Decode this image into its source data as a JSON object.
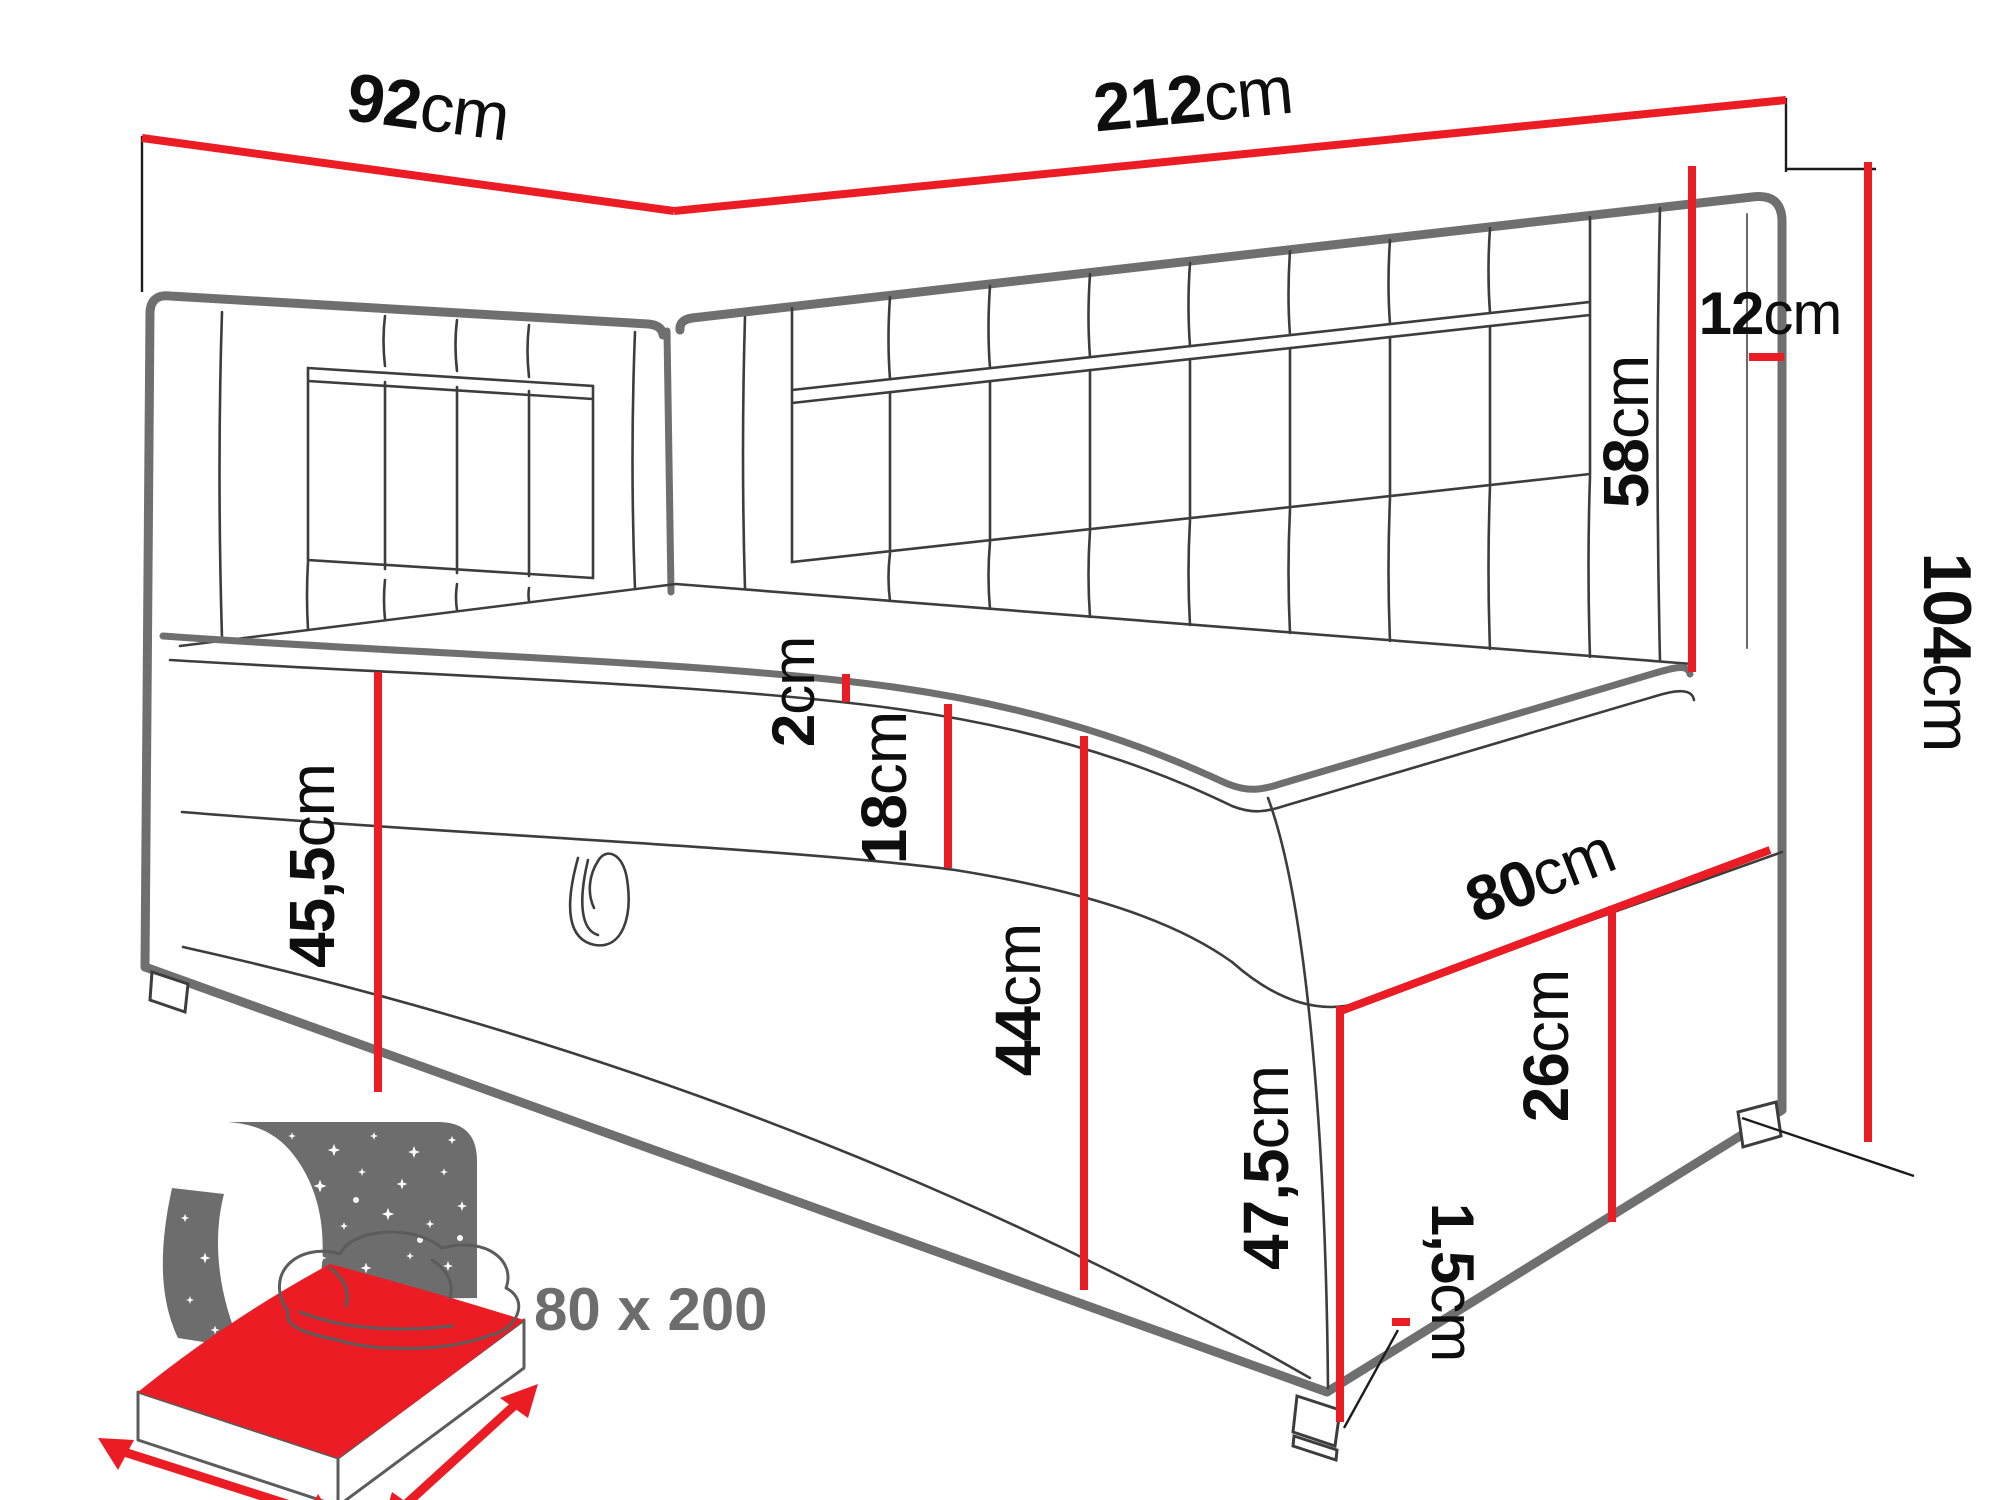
{
  "title": "corner-bed-dimension-diagram",
  "colors": {
    "dimension_red": "#ec1c24",
    "outline_gray": "#6f6f6f",
    "icon_gray": "#6d6d6d",
    "text": "#0e0e0e"
  },
  "dims": {
    "side_width": {
      "value": "92",
      "unit": "cm"
    },
    "back_width": {
      "value": "212",
      "unit": "cm"
    },
    "panel_thickness": {
      "value": "12",
      "unit": "cm"
    },
    "headboard_above_seat": {
      "value": "58",
      "unit": "cm"
    },
    "total_height": {
      "value": "104",
      "unit": "cm"
    },
    "topper_thickness": {
      "value": "2",
      "unit": "cm"
    },
    "mattress_height": {
      "value": "18",
      "unit": "cm"
    },
    "base_height": {
      "value": "44",
      "unit": "cm"
    },
    "seat_height": {
      "value": "45,5",
      "unit": "cm"
    },
    "end_width": {
      "value": "80",
      "unit": "cm"
    },
    "end_lower_height": {
      "value": "26",
      "unit": "cm"
    },
    "corner_height": {
      "value": "47,5",
      "unit": "cm"
    },
    "glide_height": {
      "value": "1,5",
      "unit": "cm"
    }
  },
  "sleeping_area": {
    "label": "80 x 200"
  }
}
